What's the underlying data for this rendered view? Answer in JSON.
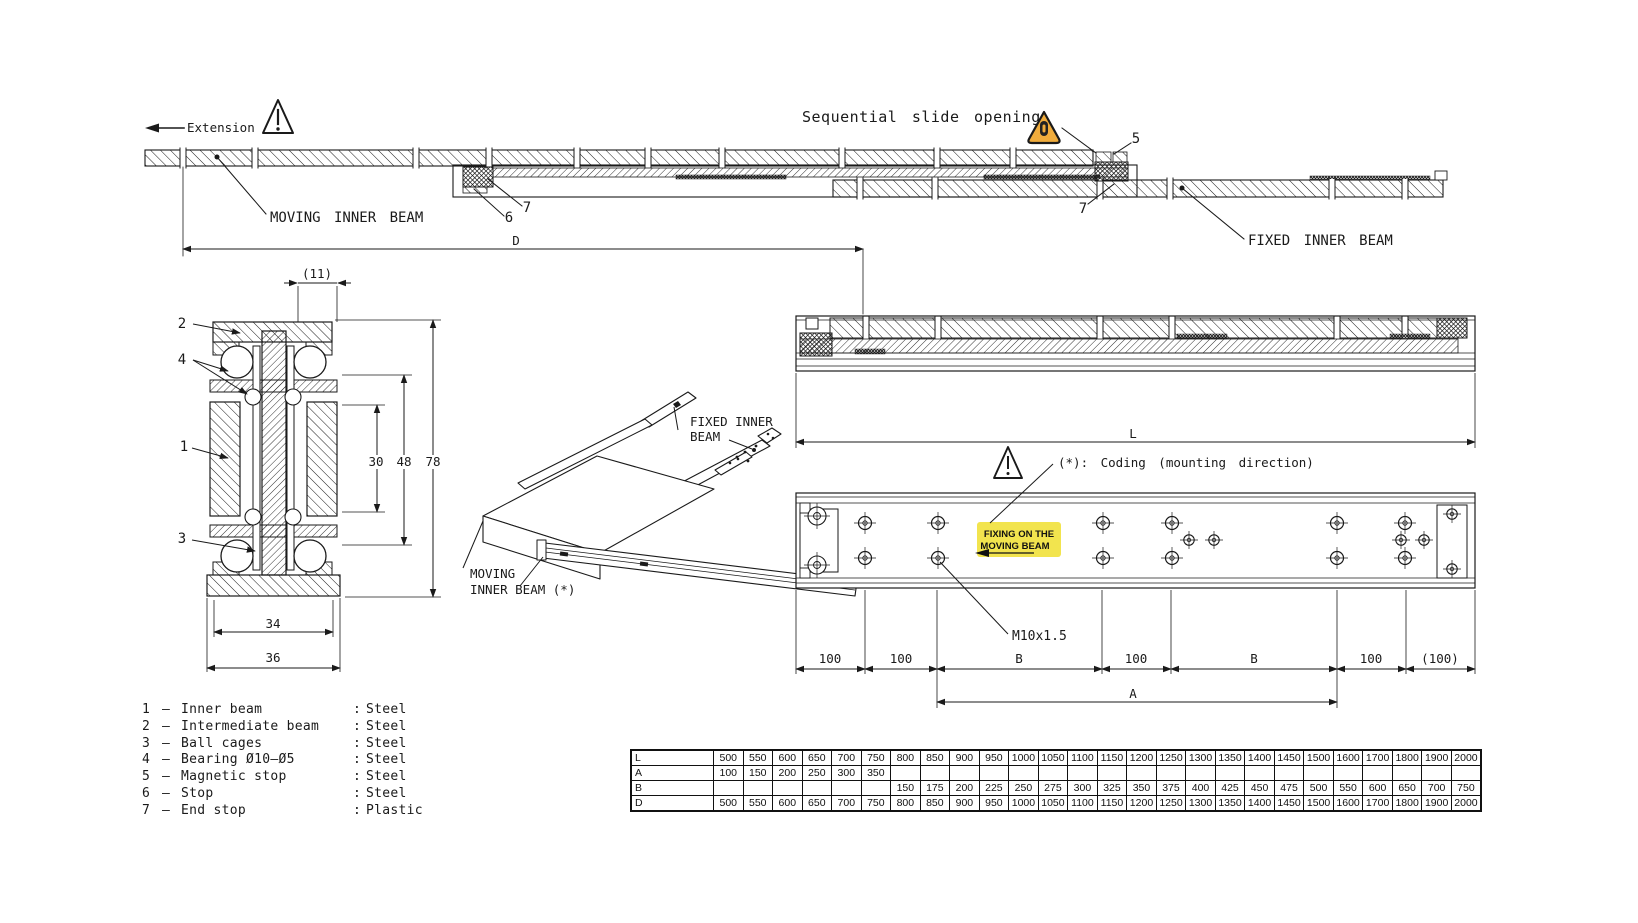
{
  "labels": {
    "extension": "Extension",
    "sequential_note": "Sequential slide opening",
    "moving_inner_beam": "MOVING INNER BEAM",
    "fixed_inner_beam": "FIXED INNER BEAM",
    "iso_fixed_beam_line1": "FIXED INNER",
    "iso_fixed_beam_line2": "BEAM",
    "iso_moving_beam_line1": "MOVING",
    "iso_moving_beam_line2": "INNER BEAM (*)",
    "coding_note": "(*): Coding (mounting direction)",
    "fixing_note_line1": "FIXING ON THE",
    "fixing_note_line2": "MOVING BEAM",
    "thread_spec": "M10x1.5"
  },
  "dims": {
    "d": "D",
    "l": "L",
    "a": "A",
    "top_offset": "(11)",
    "inner_height": "30",
    "mid_height": "48",
    "total_height": "78",
    "inner_width": "34",
    "outer_width": "36",
    "plan_segments": [
      "100",
      "100",
      "B",
      "100",
      "B",
      "100",
      "(100)"
    ]
  },
  "callouts": {
    "c1": "1",
    "c2": "2",
    "c3": "3",
    "c4": "4",
    "c5": "5",
    "c6": "6",
    "c7": "7"
  },
  "punct": {
    "dash": "–",
    "colon": ":"
  },
  "parts_list": [
    {
      "num": "1",
      "name": "Inner beam",
      "material": "Steel"
    },
    {
      "num": "2",
      "name": "Intermediate beam",
      "material": "Steel"
    },
    {
      "num": "3",
      "name": "Ball cages",
      "material": "Steel"
    },
    {
      "num": "4",
      "name": "Bearing Ø10–Ø5",
      "material": "Steel"
    },
    {
      "num": "5",
      "name": "Magnetic stop",
      "material": "Steel"
    },
    {
      "num": "6",
      "name": "Stop",
      "material": "Steel"
    },
    {
      "num": "7",
      "name": "End stop",
      "material": "Plastic"
    }
  ],
  "size_table": {
    "rows": [
      {
        "label": "L",
        "values": [
          "500",
          "550",
          "600",
          "650",
          "700",
          "750",
          "800",
          "850",
          "900",
          "950",
          "1000",
          "1050",
          "1100",
          "1150",
          "1200",
          "1250",
          "1300",
          "1350",
          "1400",
          "1450",
          "1500",
          "1600",
          "1700",
          "1800",
          "1900",
          "2000"
        ]
      },
      {
        "label": "A",
        "values": [
          "100",
          "150",
          "200",
          "250",
          "300",
          "350",
          "",
          "",
          "",
          "",
          "",
          "",
          "",
          "",
          "",
          "",
          "",
          "",
          "",
          "",
          "",
          "",
          "",
          "",
          "",
          ""
        ]
      },
      {
        "label": "B",
        "values": [
          "",
          "",
          "",
          "",
          "",
          "",
          "150",
          "175",
          "200",
          "225",
          "250",
          "275",
          "300",
          "325",
          "350",
          "375",
          "400",
          "425",
          "450",
          "475",
          "500",
          "550",
          "600",
          "650",
          "700",
          "750"
        ]
      },
      {
        "label": "D",
        "values": [
          "500",
          "550",
          "600",
          "650",
          "700",
          "750",
          "800",
          "850",
          "900",
          "950",
          "1000",
          "1050",
          "1100",
          "1150",
          "1200",
          "1250",
          "1300",
          "1350",
          "1400",
          "1450",
          "1500",
          "1600",
          "1700",
          "1800",
          "1900",
          "2000"
        ]
      }
    ]
  },
  "colors": {
    "line": "#1a1a1a",
    "highlight": "#f2e44e",
    "warning_fill": "#f0ac3c"
  }
}
